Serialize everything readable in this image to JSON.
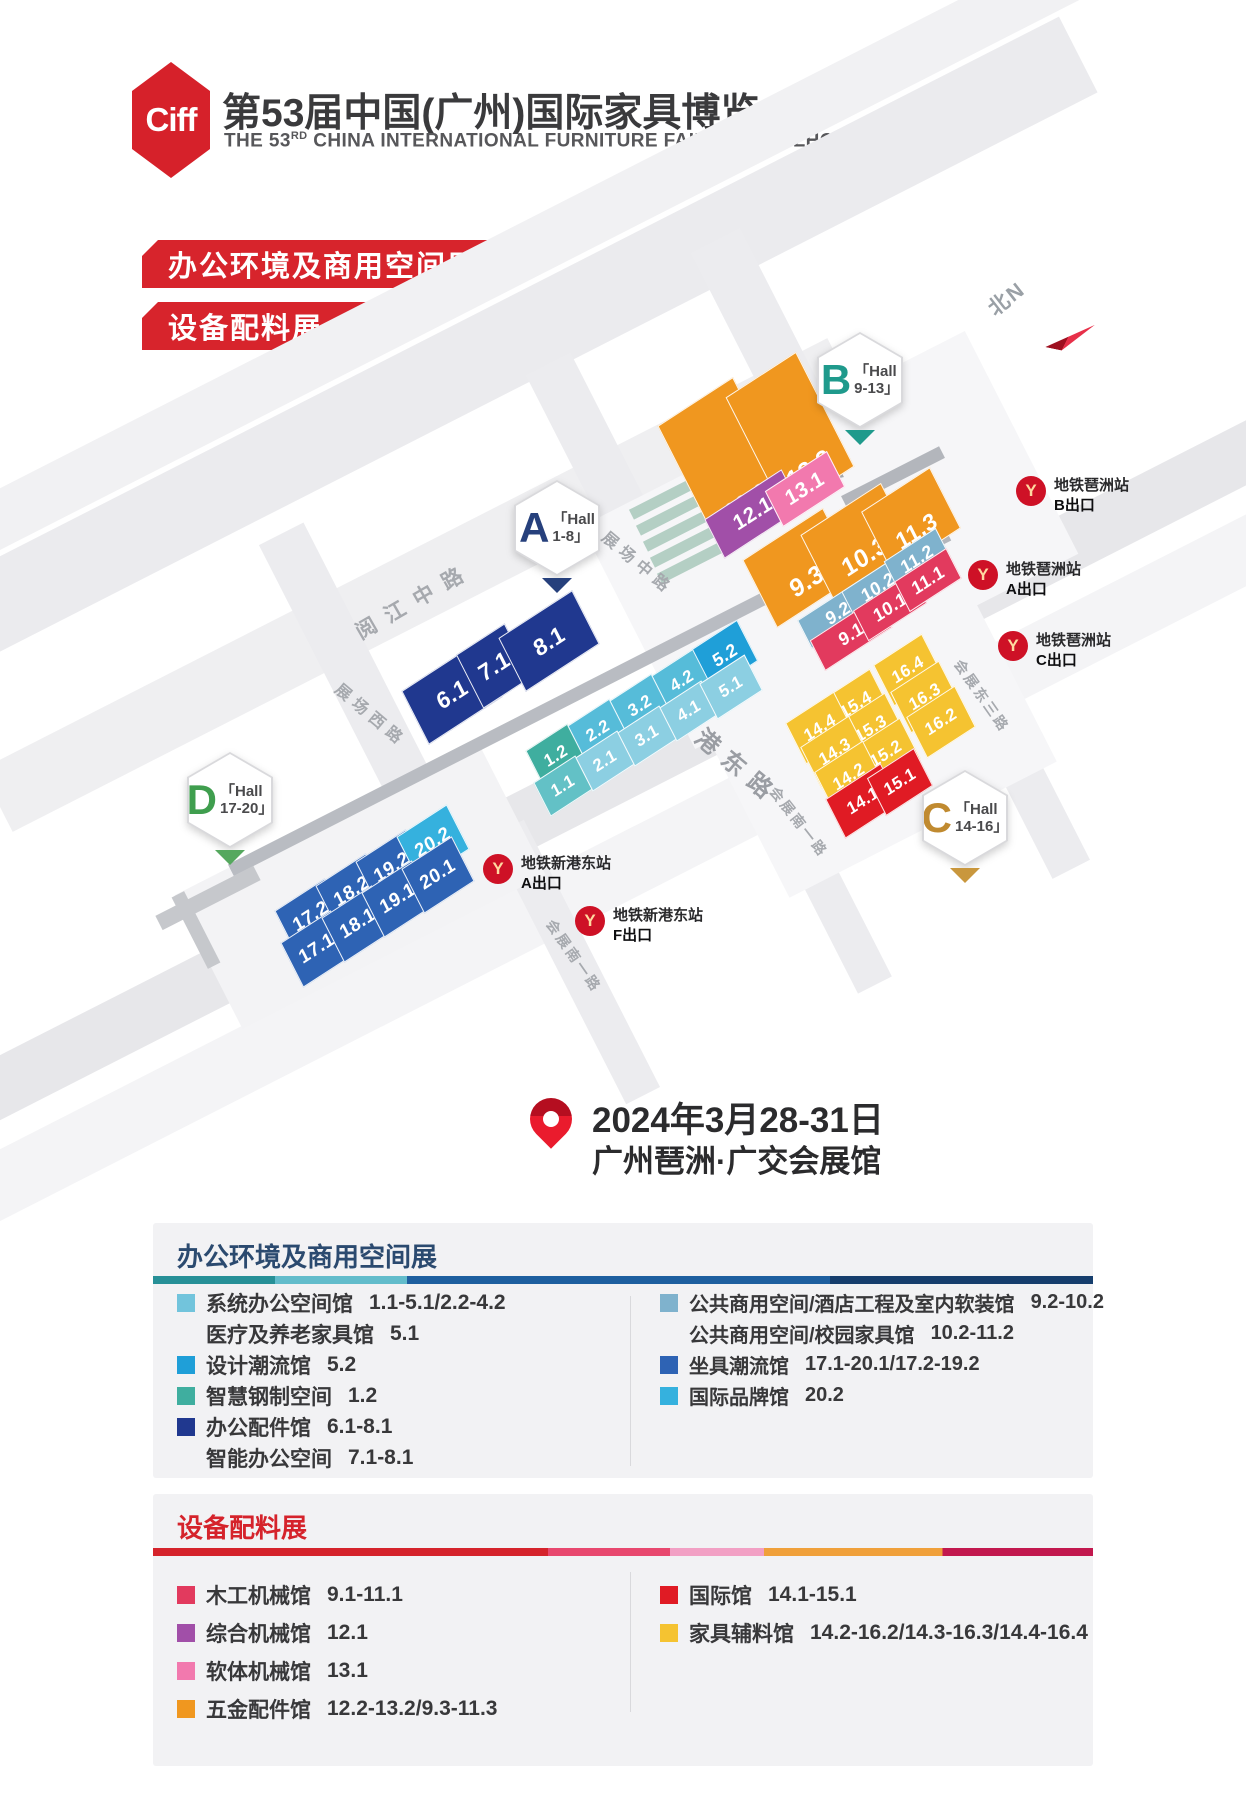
{
  "header": {
    "logo_text": "Ciff",
    "title": "第53届中国(广州)国际家具博览会",
    "subtitle_prefix": "THE 53",
    "subtitle_sup": "RD",
    "subtitle_suffix": " CHINA INTERNATIONAL FURNITURE FAIR (GUANGZHOU)"
  },
  "banners": {
    "office": "办公环境及商用空间展",
    "equipment": "设备配料展"
  },
  "compass": {
    "label": "北N"
  },
  "icons": {
    "metro_glyph": "Y"
  },
  "badges": {
    "a": {
      "letter": "A",
      "line1": "「Hall",
      "line2": "1-8」"
    },
    "b": {
      "letter": "B",
      "line1": "「Hall",
      "line2": "9-13」"
    },
    "c": {
      "letter": "C",
      "line1": "「Hall",
      "line2": "14-16」"
    },
    "d": {
      "letter": "D",
      "line1": "「Hall",
      "line2": "17-20」"
    }
  },
  "roads": {
    "yuejiang_zhong": "阅江中路",
    "zhanchang_dong": "展场东路",
    "zhanchang_zhong": "展场中路",
    "zhanchang_xi": "展场西路",
    "xingang_dong": "新港东路",
    "huizhan_dong_3": "会展东三路",
    "huizhan_nan_1": "会展南一路",
    "huizhan_nan_1b": "会展南一路"
  },
  "metro": {
    "pazhou_b": {
      "station": "地铁琶洲站",
      "exit": "B出口"
    },
    "pazhou_a": {
      "station": "地铁琶洲站",
      "exit": "A出口"
    },
    "pazhou_c": {
      "station": "地铁琶洲站",
      "exit": "C出口"
    },
    "xingang_a": {
      "station": "地铁新港东站",
      "exit": "A出口"
    },
    "xingang_f": {
      "station": "地铁新港东站",
      "exit": "F出口"
    }
  },
  "event": {
    "date": "2024年3月28-31日",
    "venue": "广州琶洲·广交会展馆"
  },
  "palette": {
    "orange": "#f0971f",
    "purple": "#a14fa8",
    "pink": "#f279ae",
    "crimson": "#e23a5e",
    "steel": "#7fb2cd",
    "navy": "#20388f",
    "cyan_dark": "#56bcd9",
    "cyan_light": "#8ccfe2",
    "teal": "#3fae9f",
    "teal_cyan": "#63c1c6",
    "bright_blue": "#1f9fd8",
    "royal": "#2e63b4",
    "light_blue": "#35b1de",
    "yellow": "#f5c331",
    "red": "#e01b24",
    "sage": "#b4cfc4"
  },
  "blocks": {
    "h1_1": "1.1",
    "h1_2": "1.2",
    "h2_1": "2.1",
    "h2_2": "2.2",
    "h3_1": "3.1",
    "h3_2": "3.2",
    "h4_1": "4.1",
    "h4_2": "4.2",
    "h5_1": "5.1",
    "h5_2": "5.2",
    "h6_1": "6.1",
    "h7_1": "7.1",
    "h8_1": "8.1",
    "h9_1": "9.1",
    "h9_2": "9.2",
    "h9_3": "9.3",
    "h10_1": "10.1",
    "h10_2": "10.2",
    "h10_3": "10.3",
    "h11_1": "11.1",
    "h11_2": "11.2",
    "h11_3": "11.3",
    "h12_1": "12.1",
    "h12_2": "12.2",
    "h13_1": "13.1",
    "h13_2": "13.2",
    "h14_1": "14.1",
    "h14_2": "14.2",
    "h14_3": "14.3",
    "h14_4": "14.4",
    "h15_1": "15.1",
    "h15_2": "15.2",
    "h15_3": "15.3",
    "h15_4": "15.4",
    "h16_2": "16.2",
    "h16_3": "16.3",
    "h16_4": "16.4",
    "h17_1": "17.1",
    "h17_2": "17.2",
    "h18_1": "18.1",
    "h18_2": "18.2",
    "h19_1": "19.1",
    "h19_2": "19.2",
    "h20_1": "20.1",
    "h20_2": "20.2"
  },
  "legend_office": {
    "title": "办公环境及商用空间展",
    "left": [
      {
        "name": "系统办公空间馆",
        "range": "1.1-5.1/2.2-4.2",
        "swatch": "#72c4dc"
      },
      {
        "name": "医疗及养老家具馆",
        "range": "5.1",
        "swatch": ""
      },
      {
        "name": "设计潮流馆",
        "range": "5.2",
        "swatch": "#1f9fd8"
      },
      {
        "name": "智慧钢制空间",
        "range": "1.2",
        "swatch": "#3fae9f"
      },
      {
        "name": "办公配件馆",
        "range": "6.1-8.1",
        "swatch": "#20388f"
      },
      {
        "name": "智能办公空间",
        "range": "7.1-8.1",
        "swatch": ""
      }
    ],
    "right": [
      {
        "name": "公共商用空间/酒店工程及室内软装馆",
        "range": "9.2-10.2",
        "swatch": "#7fb2cd"
      },
      {
        "name": "公共商用空间/校园家具馆",
        "range": "10.2-11.2",
        "swatch": ""
      },
      {
        "name": "坐具潮流馆",
        "range": "17.1-20.1/17.2-19.2",
        "swatch": "#2e63b4"
      },
      {
        "name": "国际品牌馆",
        "range": "20.2",
        "swatch": "#35b1de"
      }
    ]
  },
  "legend_equipment": {
    "title": "设备配料展",
    "left": [
      {
        "name": "木工机械馆",
        "range": "9.1-11.1",
        "swatch": "#e23a5e"
      },
      {
        "name": "综合机械馆",
        "range": "12.1",
        "swatch": "#a14fa8"
      },
      {
        "name": "软体机械馆",
        "range": "13.1",
        "swatch": "#f279ae"
      },
      {
        "name": "五金配件馆",
        "range": "12.2-13.2/9.3-11.3",
        "swatch": "#f0971f"
      }
    ],
    "right": [
      {
        "name": "国际馆",
        "range": "14.1-15.1",
        "swatch": "#e01b24"
      },
      {
        "name": "家具辅料馆",
        "range": "14.2-16.2/14.3-16.3/14.4-16.4",
        "swatch": "#f5c331"
      }
    ]
  }
}
